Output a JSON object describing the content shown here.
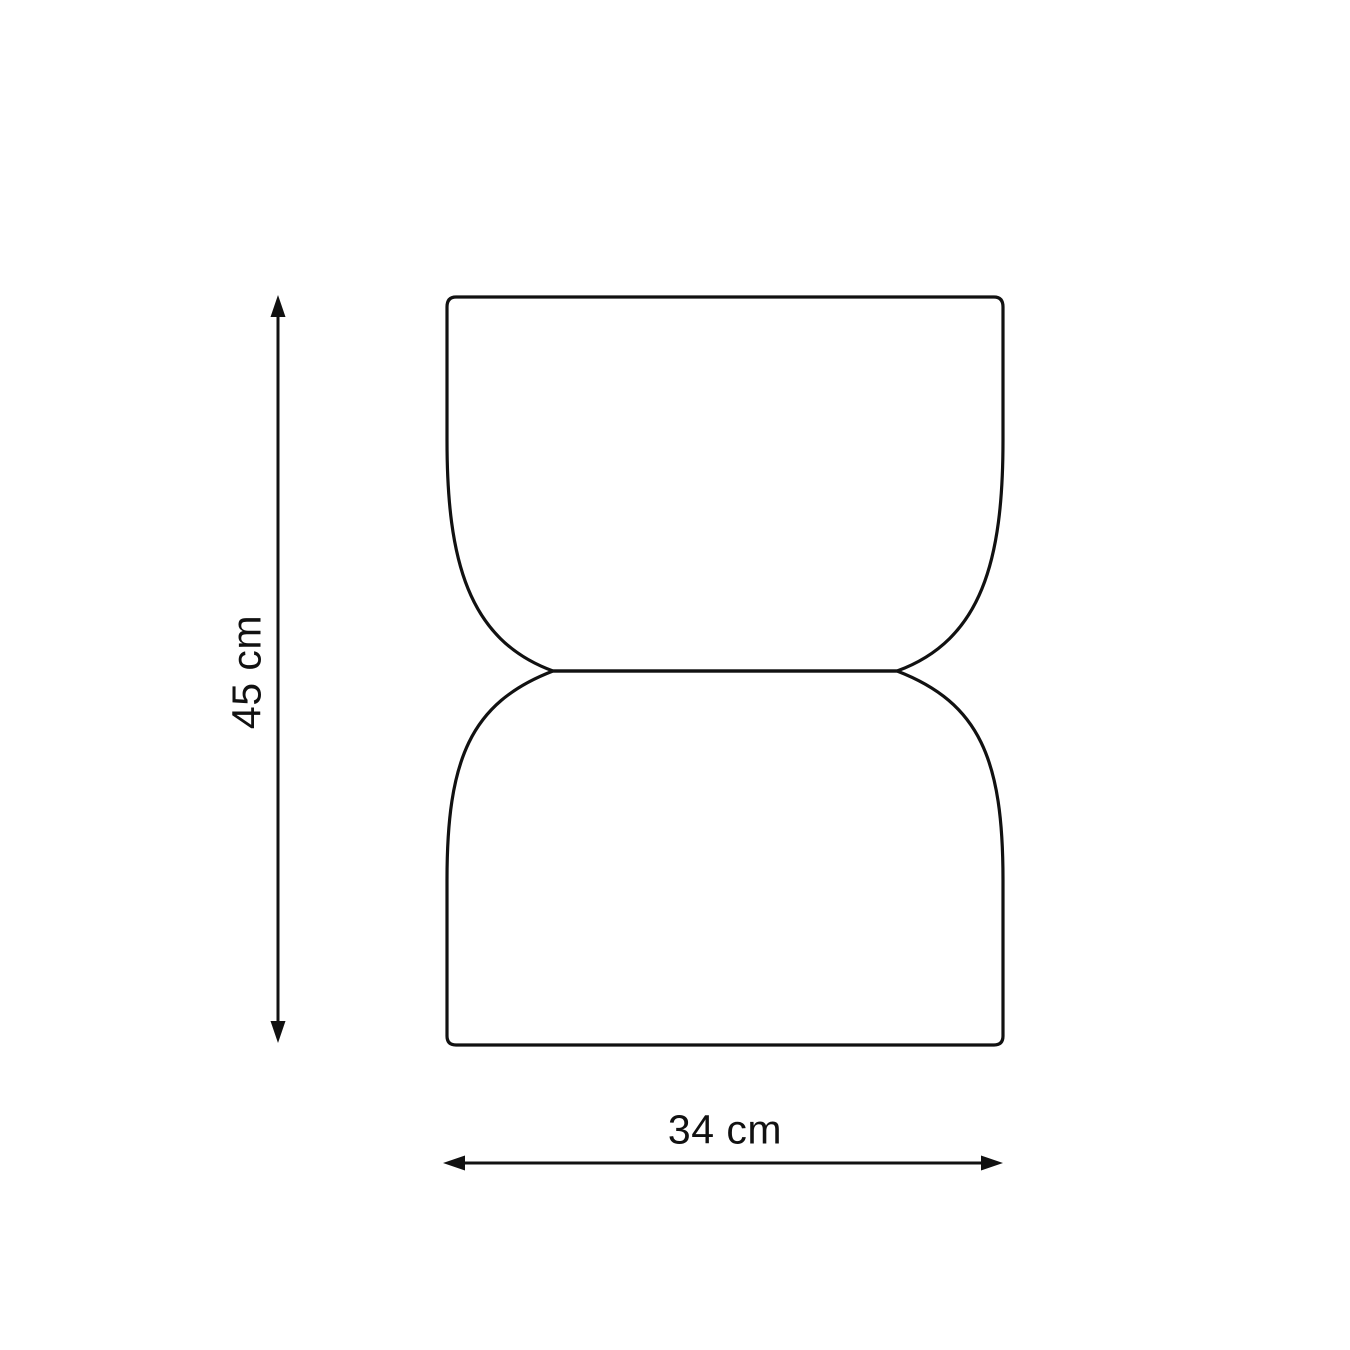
{
  "diagram": {
    "shape": "hourglass-stool-outline",
    "outline_color": "#111111",
    "background_color": "#ffffff",
    "height_dimension": {
      "label": "45 cm",
      "value": 45,
      "unit": "cm"
    },
    "width_dimension": {
      "label": "34 cm",
      "value": 34,
      "unit": "cm"
    }
  }
}
